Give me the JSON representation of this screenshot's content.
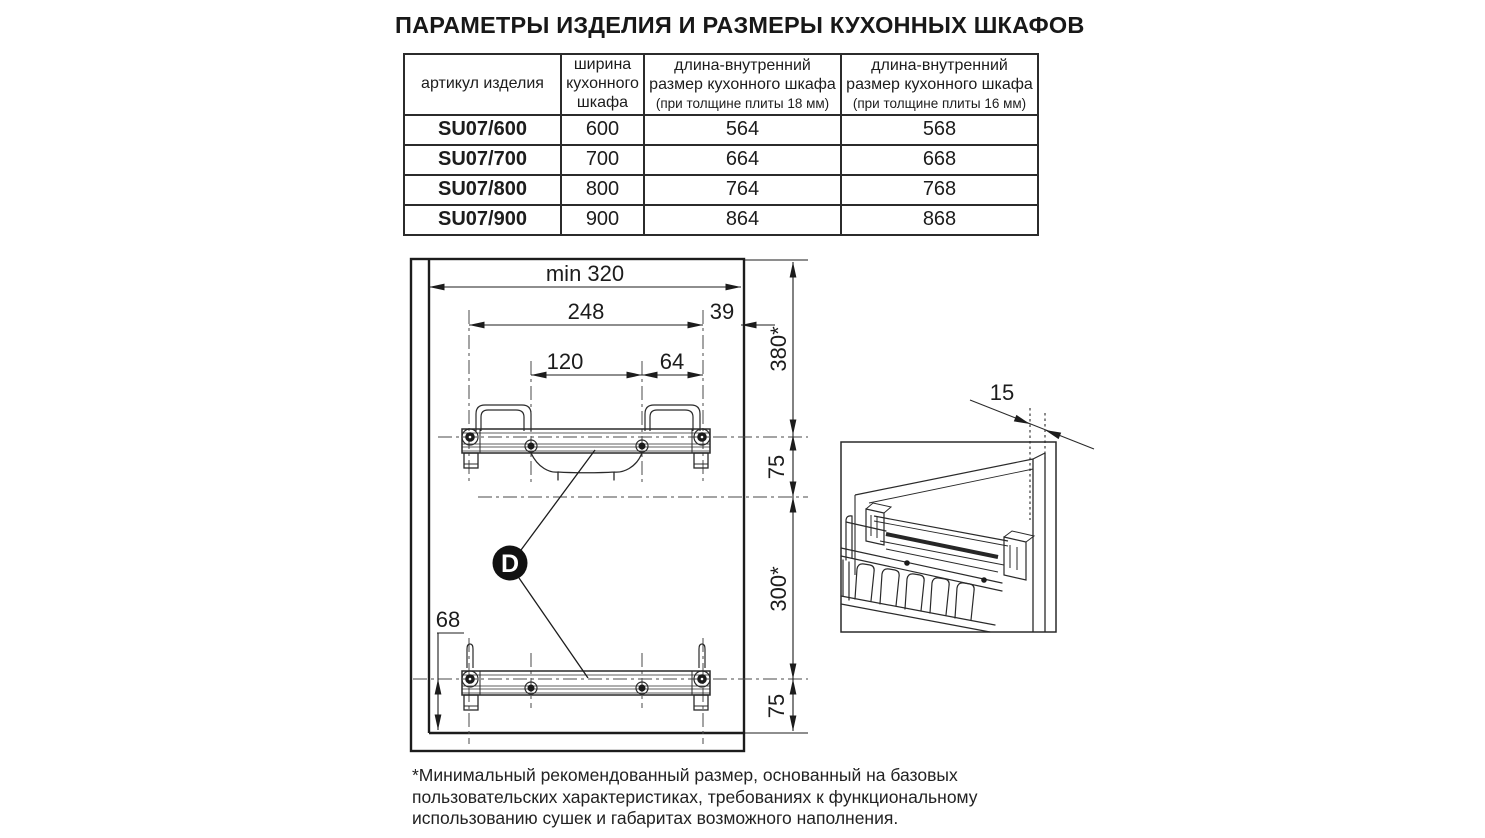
{
  "title": "ПАРАМЕТРЫ ИЗДЕЛИЯ И РАЗМЕРЫ КУХОННЫХ ШКАФОВ",
  "table": {
    "col_article": "артикул изделия",
    "col_width": "ширина кухонного шкафа",
    "col_len18_main": "длина-внутренний размер кухонного шкафа",
    "col_len18_sub": "(при толщине плиты 18 мм)",
    "col_len16_main": "длина-внутренний размер кухонного шкафа",
    "col_len16_sub": "(при толщине плиты 16 мм)",
    "rows": [
      {
        "article": "SU07/600",
        "width": "600",
        "len18": "564",
        "len16": "568"
      },
      {
        "article": "SU07/700",
        "width": "700",
        "len18": "664",
        "len16": "668"
      },
      {
        "article": "SU07/800",
        "width": "800",
        "len18": "764",
        "len16": "768"
      },
      {
        "article": "SU07/900",
        "width": "900",
        "len18": "864",
        "len16": "868"
      }
    ]
  },
  "diagram": {
    "dim_min_width": "min 320",
    "dim_248": "248",
    "dim_39": "39",
    "dim_120": "120",
    "dim_64": "64",
    "dim_380": "380*",
    "dim_75_top": "75",
    "dim_300": "300*",
    "dim_75_bottom": "75",
    "dim_68": "68",
    "marker_d": "D",
    "detail_dim_15": "15"
  },
  "footnote": "*Минимальный рекомендованный размер, основанный на базовых пользовательских характеристиках, требованиях к функциональному использованию сушек и габаритах возможного наполнения.",
  "colors": {
    "line": "#1c1c1c",
    "centerline": "#4a4a4a",
    "background": "#ffffff"
  }
}
